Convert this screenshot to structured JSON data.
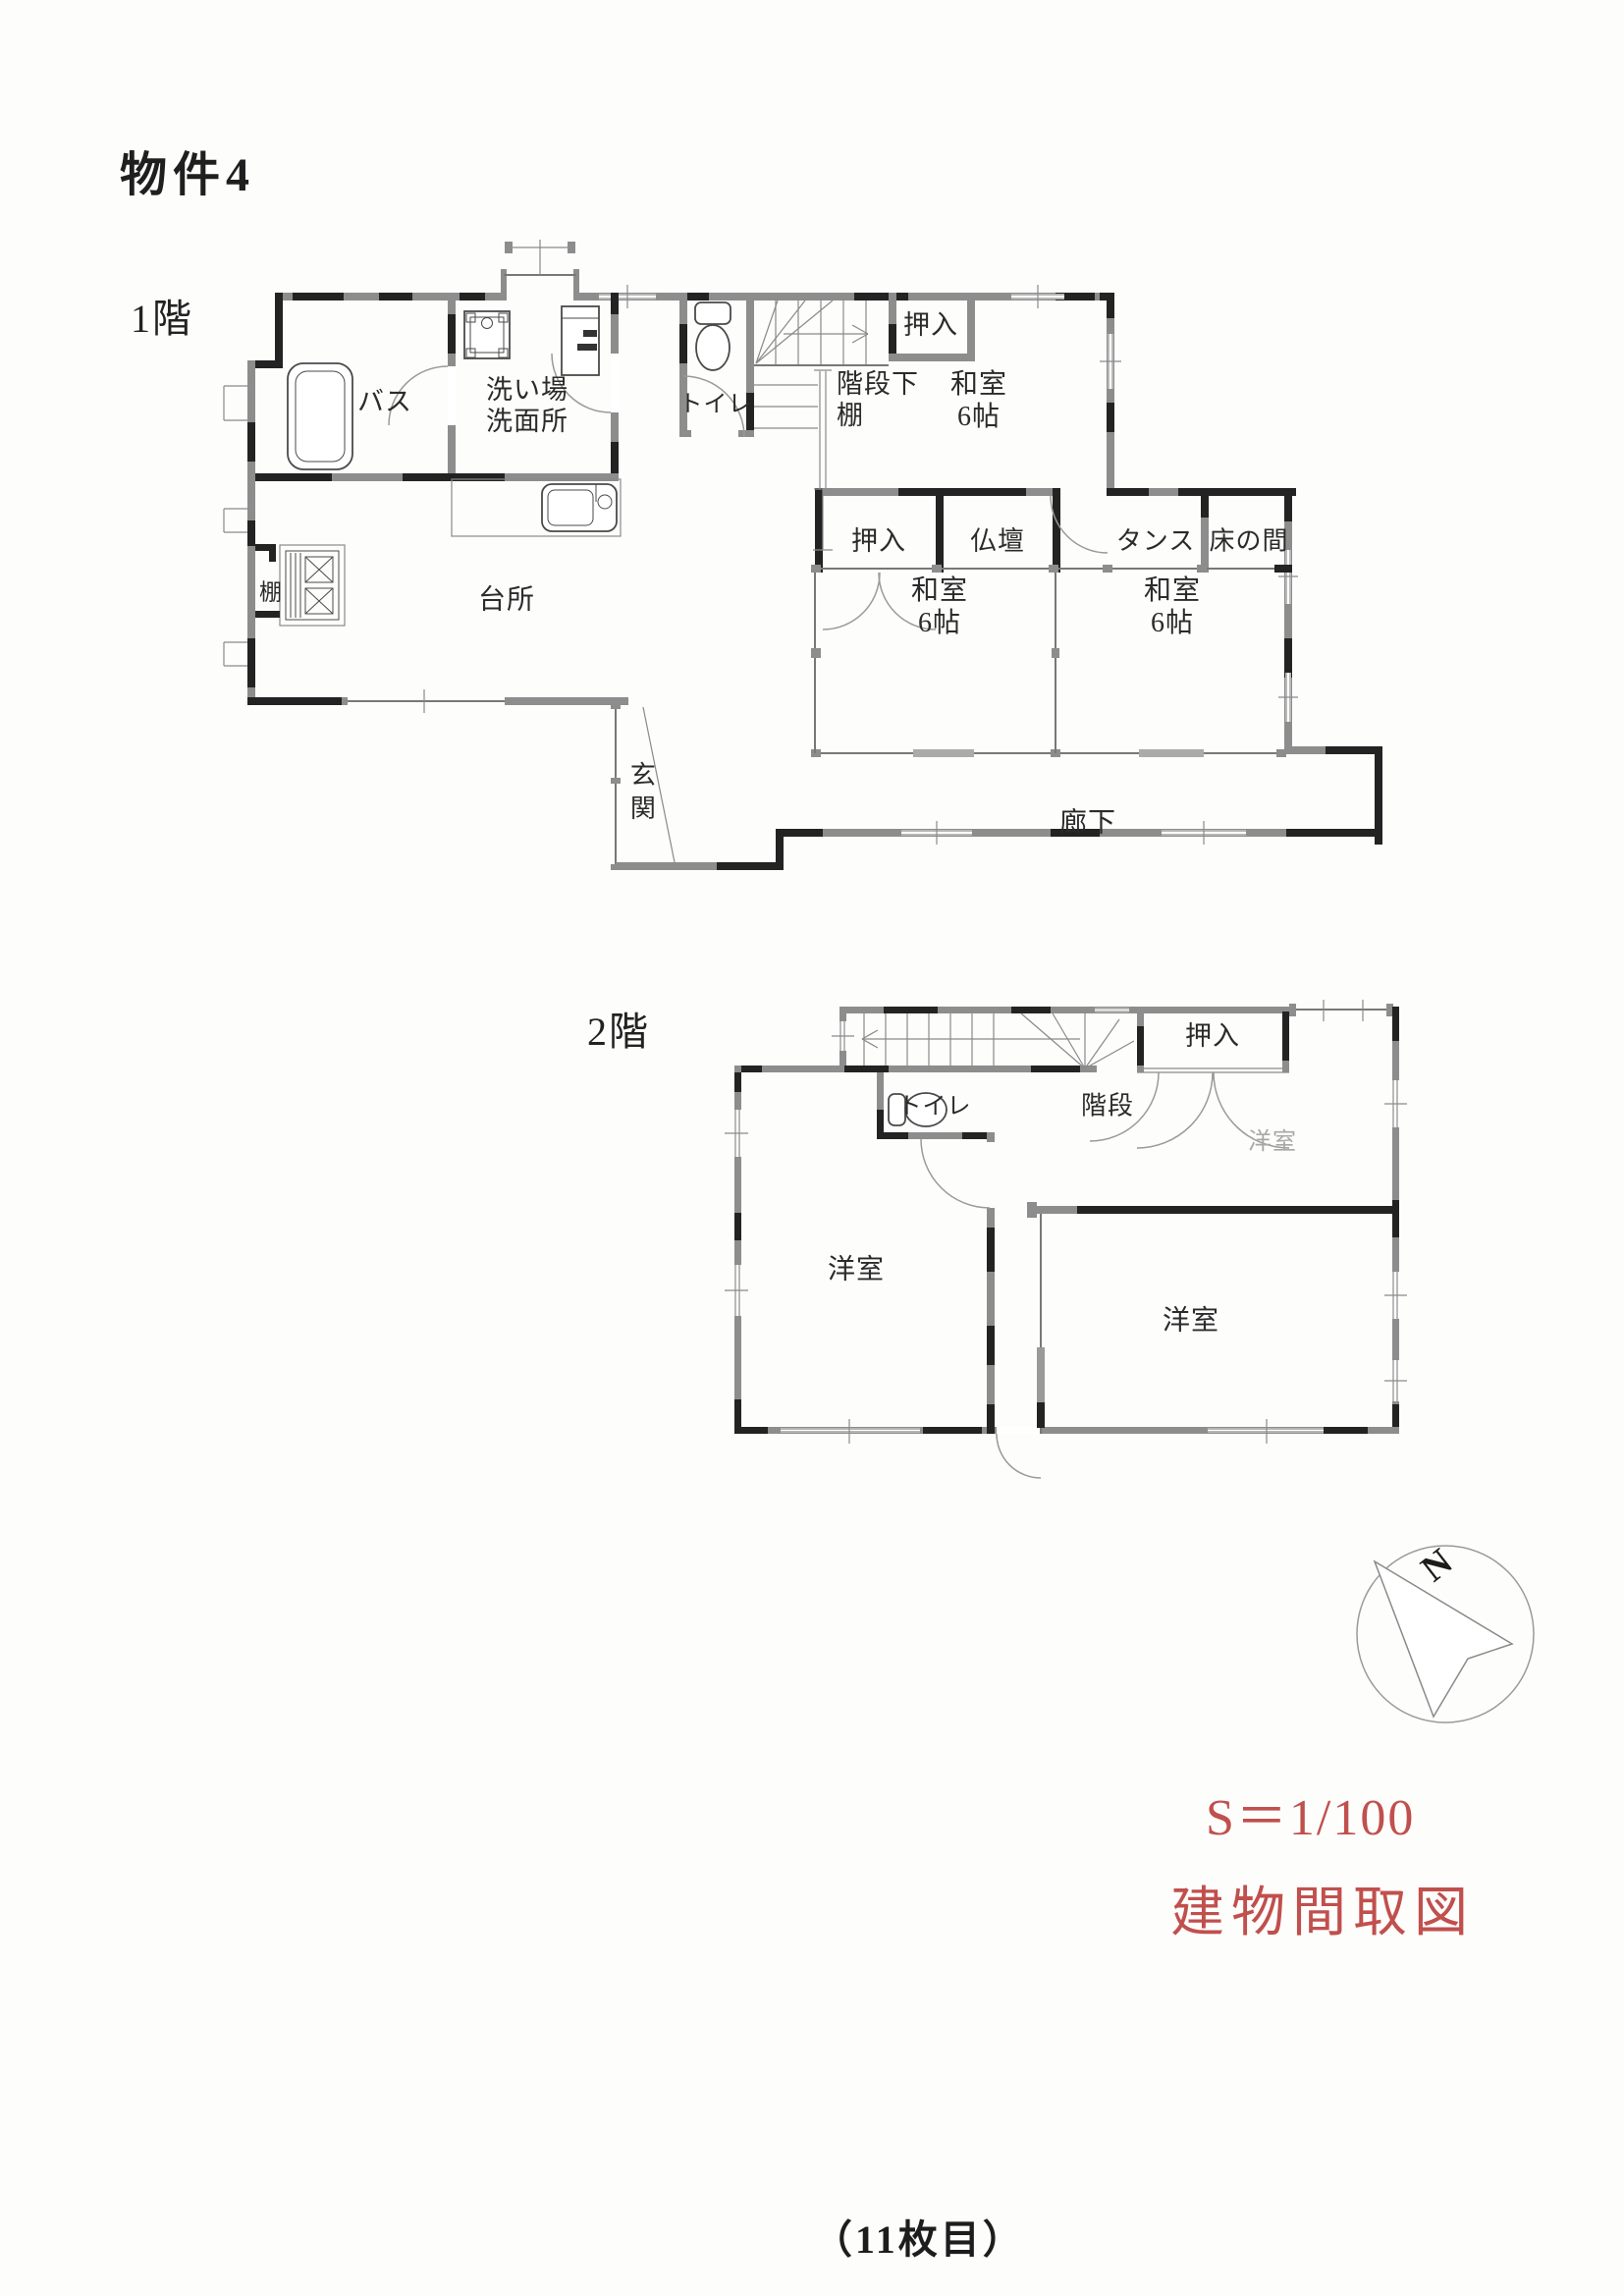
{
  "document": {
    "title": "物件4",
    "scale_label": "S＝1/100",
    "drawing_type_label": "建物間取図",
    "page_number": "（11枚目）",
    "accent_color": "#c0504d"
  },
  "compass": {
    "north_label": "N"
  },
  "floor1": {
    "floor_label": "1階",
    "rooms": {
      "bath": "バス",
      "washroom": "洗い場\n洗面所",
      "toilet": "トイレ",
      "under_stairs_shelf": "階段下\n棚",
      "closet_upper": "押入",
      "tatami_room_upper": "和室\n6帖",
      "closet_middle": "押入",
      "butsudan": "仏壇",
      "tansu": "タンス",
      "tokonoma": "床の間",
      "tatami_room_left": "和室\n6帖",
      "tatami_room_right": "和室\n6帖",
      "kitchen": "台所",
      "shelf": "棚",
      "entrance": "玄関",
      "corridor": "廊下"
    }
  },
  "floor2": {
    "floor_label": "2階",
    "rooms": {
      "toilet": "トイレ",
      "stairs": "階段",
      "closet": "押入",
      "western_room_left": "洋室",
      "western_room_right": "洋室",
      "western_room_upper": "洋室"
    }
  }
}
